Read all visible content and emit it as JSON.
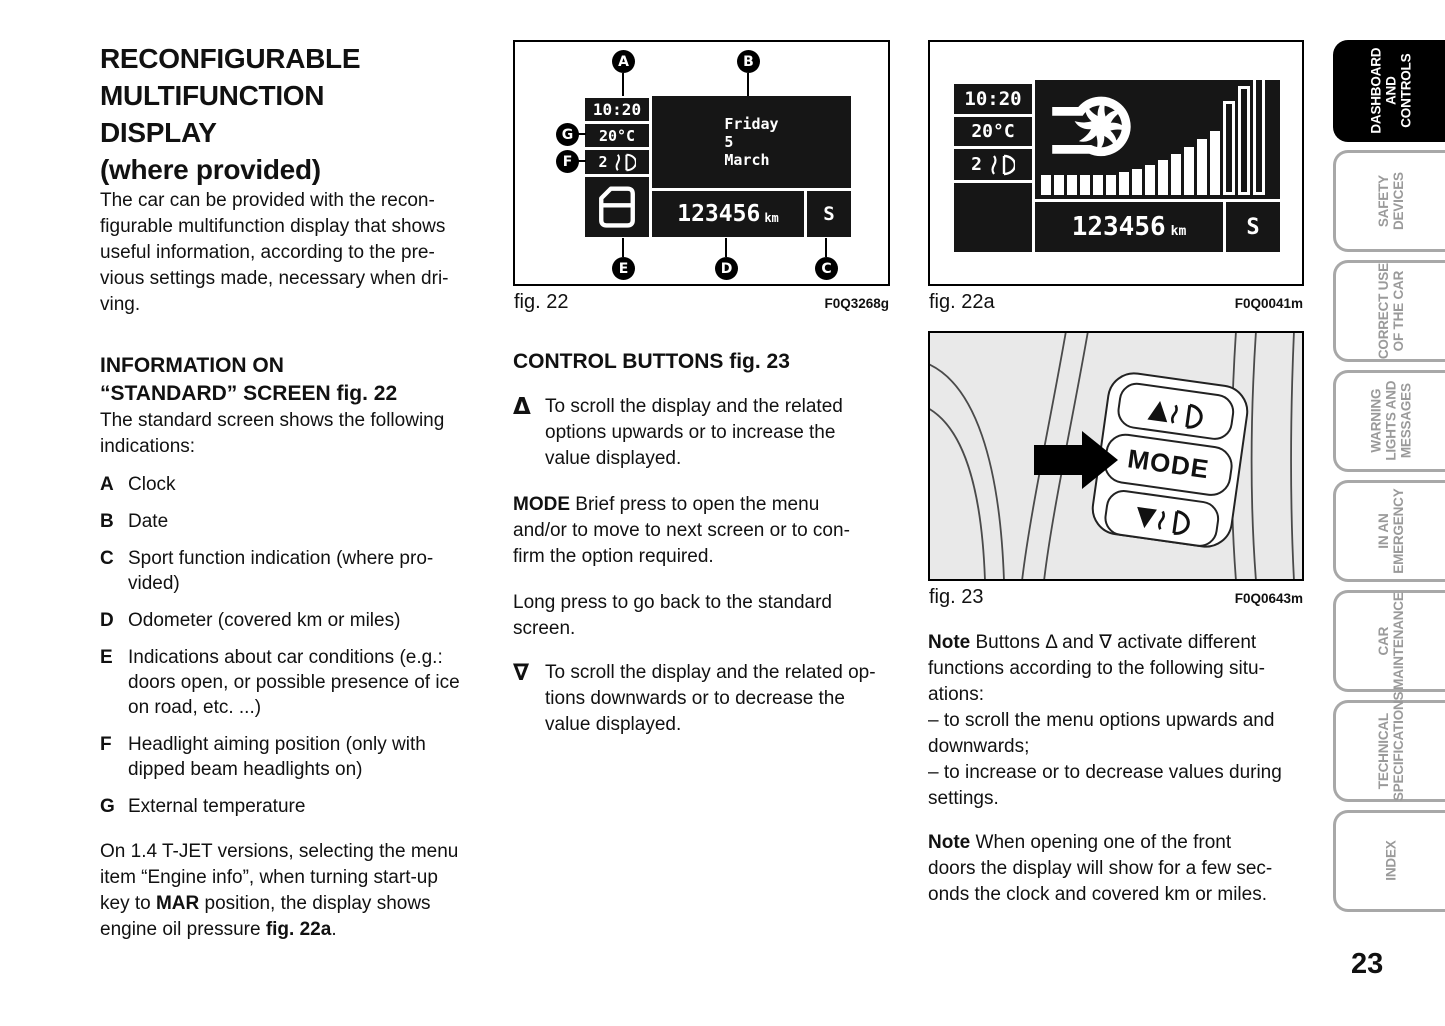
{
  "page_number": "23",
  "left": {
    "title_lines": [
      "RECONFIGURABLE",
      "MULTIFUNCTION",
      "DISPLAY",
      "(where provided)"
    ],
    "intro_lines": [
      "The car can be provided with the recon-",
      "figurable multifunction display that shows",
      "useful information, according to the pre-",
      "vious settings made, necessary when dri-",
      "ving."
    ],
    "info_heading_lines": [
      "INFORMATION ON",
      "“STANDARD” SCREEN fig. 22"
    ],
    "standard_lines": [
      "The standard screen shows the following",
      "indications:"
    ],
    "items": [
      {
        "letter": "A",
        "lines": [
          "Clock"
        ]
      },
      {
        "letter": "B",
        "lines": [
          "Date"
        ]
      },
      {
        "letter": "C",
        "lines": [
          "Sport function indication (where pro-",
          "vided)"
        ]
      },
      {
        "letter": "D",
        "lines": [
          "Odometer (covered km or miles)"
        ]
      },
      {
        "letter": "E",
        "lines": [
          "Indications about car conditions (e.g.:",
          "doors open, or possible presence of ice",
          "on road, etc. ...)"
        ]
      },
      {
        "letter": "F",
        "lines": [
          "Headlight aiming position (only with",
          "dipped beam headlights on)"
        ]
      },
      {
        "letter": "G",
        "lines": [
          "External temperature"
        ]
      }
    ],
    "tjet": {
      "l1": "On 1.4 T-JET versions, selecting the menu",
      "l2": "item “Engine info”, when turning start-up",
      "l3a": "key to ",
      "l3b": "MAR",
      "l3c": " position, the display shows",
      "l4a": "engine oil pressure ",
      "l4b": "fig. 22a",
      "l4c": "."
    }
  },
  "mid": {
    "fig22": {
      "caption": "fig. 22",
      "code": "F0Q3268g",
      "clock": "10:20",
      "temp": "20°C",
      "level": "2",
      "date_lines": [
        "Friday",
        "5",
        "March"
      ],
      "odometer": "123456",
      "odo_unit": "km",
      "sport": "S",
      "callouts": {
        "a": "A",
        "b": "B",
        "c": "C",
        "d": "D",
        "e": "E",
        "f": "F",
        "g": "G"
      }
    },
    "heading": "CONTROL BUTTONS fig. 23",
    "up_bullet": {
      "marker": "Δ",
      "lines": [
        "To scroll the display and the related",
        "options upwards or to increase the",
        "value displayed."
      ]
    },
    "mode_para": {
      "label": "MODE",
      "first": " Brief press to open the menu",
      "rest": [
        "and/or to move to next screen or to con-",
        "firm the option required."
      ]
    },
    "long_lines": [
      "Long press to go back to the standard",
      "screen."
    ],
    "down_bullet": {
      "marker": "∇",
      "lines": [
        "To scroll the display and the related op-",
        "tions downwards or to decrease the",
        "value displayed."
      ]
    }
  },
  "right": {
    "fig22a": {
      "caption": "fig. 22a",
      "code": "F0Q0041m",
      "clock": "10:20",
      "temp": "20°C",
      "level": "2",
      "odometer": "123456",
      "odo_unit": "km",
      "sport": "S",
      "bars_filled": [
        20,
        20,
        20,
        20,
        20,
        20,
        23,
        26,
        30,
        35,
        41,
        48,
        56,
        64
      ],
      "bars_outline": [
        88,
        103,
        115
      ]
    },
    "fig23": {
      "caption": "fig. 23",
      "code": "F0Q0643m",
      "mode_label": "MODE"
    },
    "note1": {
      "label": "Note",
      "lines": [
        " Buttons Δ and ∇ activate different",
        "functions according to the following situ-",
        "ations:"
      ]
    },
    "dash1_lines": [
      "– to scroll the menu options upwards and",
      "downwards;"
    ],
    "dash2_lines": [
      "– to increase or to decrease values during",
      "settings."
    ],
    "note2": {
      "label": "Note",
      "lines": [
        " When opening one of the front",
        "doors the display will show for a few sec-",
        "onds the clock and covered km or miles."
      ]
    }
  },
  "sidebar": {
    "tabs": [
      {
        "lines": [
          "DASHBOARD",
          "AND CONTROLS"
        ],
        "active": true
      },
      {
        "lines": [
          "SAFETY",
          "DEVICES"
        ],
        "active": false
      },
      {
        "lines": [
          "CORRECT USE",
          "OF THE CAR"
        ],
        "active": false
      },
      {
        "lines": [
          "WARNING",
          "LIGHTS AND",
          "MESSAGES"
        ],
        "active": false
      },
      {
        "lines": [
          "IN AN",
          "EMERGENCY"
        ],
        "active": false
      },
      {
        "lines": [
          "CAR",
          "MAINTENANCE"
        ],
        "active": false
      },
      {
        "lines": [
          "TECHNICAL",
          "SPECIFICATIONS"
        ],
        "active": false
      },
      {
        "lines": [
          "INDEX"
        ],
        "active": false
      }
    ]
  }
}
